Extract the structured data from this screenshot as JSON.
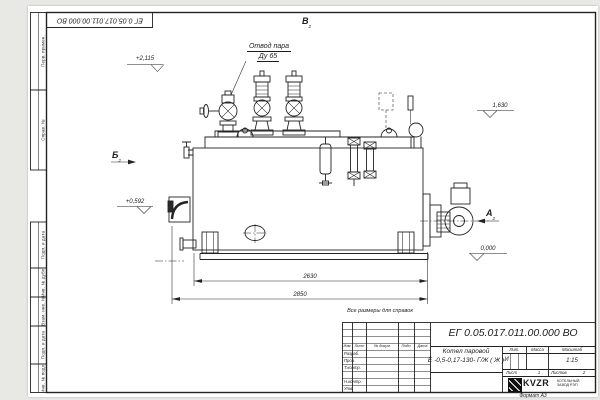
{
  "colors": {
    "background": "#e8e8e5",
    "sheet": "#ffffff",
    "line": "#222222"
  },
  "sheet": {
    "designation": "ЕГ 0.05.017.011.00.000  ВО",
    "reference_note": "Все размеры для справок",
    "format_label": "Формат А3"
  },
  "margin_columns": [
    "Перв. примен.",
    "Справ. №",
    "Подп. и дата",
    "Инв. № дубл.",
    "Взам. инв. №",
    "Подп. и дата",
    "Инв. № подл."
  ],
  "title_block": {
    "product_name_line1": "Котел паровой",
    "product_name_line2": "Е -0,5-0,17-130- Г/Ж ( Ж )",
    "header_columns": {
      "izm": "Изм.",
      "list": "Лист",
      "doc": "№ докум.",
      "podp": "Подп.",
      "data": "Дата"
    },
    "signature_rows": {
      "razrab": "Разраб.",
      "prov": "Пров.",
      "tkontr": "Т.контр.",
      "nkontr": "Н.контр.",
      "utv": "Утв."
    },
    "lit_label": "Лит.",
    "lit_value": "И",
    "mass_label": "Масса",
    "scale_label": "Масштаб",
    "scale_value": "1:15",
    "sheet_label": "Лист",
    "sheet_value": "1",
    "sheets_label": "Листов",
    "sheets_value": "2",
    "company": {
      "logo_text": "KVZR",
      "line1": "КОТЕЛЬНЫЙ",
      "line2": "ЗАВОД РЭП"
    }
  },
  "annotations": {
    "steam_outlet_line1": "Отвод пара",
    "steam_outlet_line2": "Ду 65",
    "view_a": "А",
    "view_b": "Б",
    "view_v": "В",
    "view_sheet_ref": "2",
    "elev_valves": "+2,115",
    "elev_front": "+0,592",
    "elev_rear": "1,630",
    "elev_ground": "0,000",
    "dim_shell_length": "2630",
    "dim_overall_length": "2850"
  }
}
